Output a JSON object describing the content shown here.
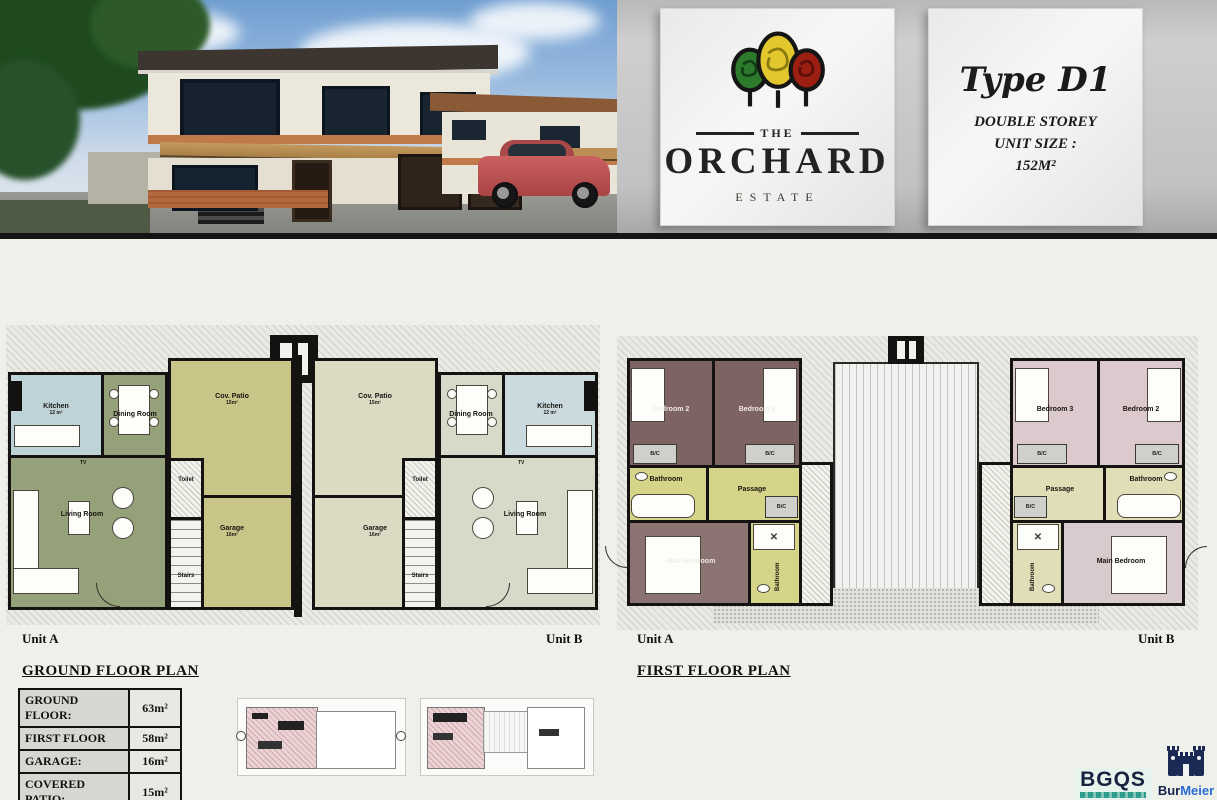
{
  "header": {
    "logo": {
      "the": "THE",
      "orchard": "ORCHARD",
      "estate": "ESTATE"
    },
    "type_panel": {
      "title": "Type D1",
      "line1": "DOUBLE STOREY",
      "line2": "UNIT SIZE :",
      "line3": "152M²"
    }
  },
  "ground_floor": {
    "title": "GROUND FLOOR PLAN",
    "unit_a": "Unit A",
    "unit_b": "Unit B",
    "rooms": {
      "kitchen": "Kitchen",
      "kitchen_area": "12 m²",
      "dining": "Dining Room",
      "living": "Living Room",
      "cov_patio": "Cov. Patio",
      "patio_area": "15m²",
      "garage": "Garage",
      "garage_area": "16m²",
      "toilet": "Toilet",
      "stairs": "Stairs",
      "tv": "TV"
    }
  },
  "first_floor": {
    "title": "FIRST FLOOR PLAN",
    "unit_a": "Unit A",
    "unit_b": "Unit B",
    "rooms": {
      "bedroom2": "Bedroom 2",
      "bedroom3": "Bedroom 3",
      "bathroom": "Bathroom",
      "passage": "Passage",
      "main_bedroom": "Main Bedroom",
      "bc": "B/C"
    }
  },
  "area_table": {
    "rows": [
      {
        "label": "GROUND FLOOR:",
        "value": "63m²"
      },
      {
        "label": "FIRST FLOOR",
        "value": "58m²"
      },
      {
        "label": "GARAGE:",
        "value": "16m²"
      },
      {
        "label": "COVERED PATIO:",
        "value": "15m²"
      },
      {
        "label": "TOTAL:",
        "value": "152m²"
      }
    ]
  },
  "footer": {
    "bgqs": "BGQS",
    "burmeier_bur": "Bur",
    "burmeier_meier": "Meier"
  },
  "colors": {
    "tree_green": "#2d7a2d",
    "tree_yellow": "#e3c72e",
    "tree_red": "#9c1f12",
    "gf_unit_a_living": "#95a179",
    "gf_unit_a_kitchen": "#bdd3d8",
    "gf_unit_a_patio": "#c9c487",
    "gf_unit_b_living": "#d6dbc9",
    "gf_unit_b_kitchen": "#cadade",
    "gf_unit_b_patio": "#dbdbc4",
    "ff_unit_a_bedroom": "#7d6361",
    "ff_unit_a_bath": "#d6d489",
    "ff_unit_b_bedroom": "#dcc9cd",
    "ff_unit_b_bath": "#e0deb6"
  }
}
